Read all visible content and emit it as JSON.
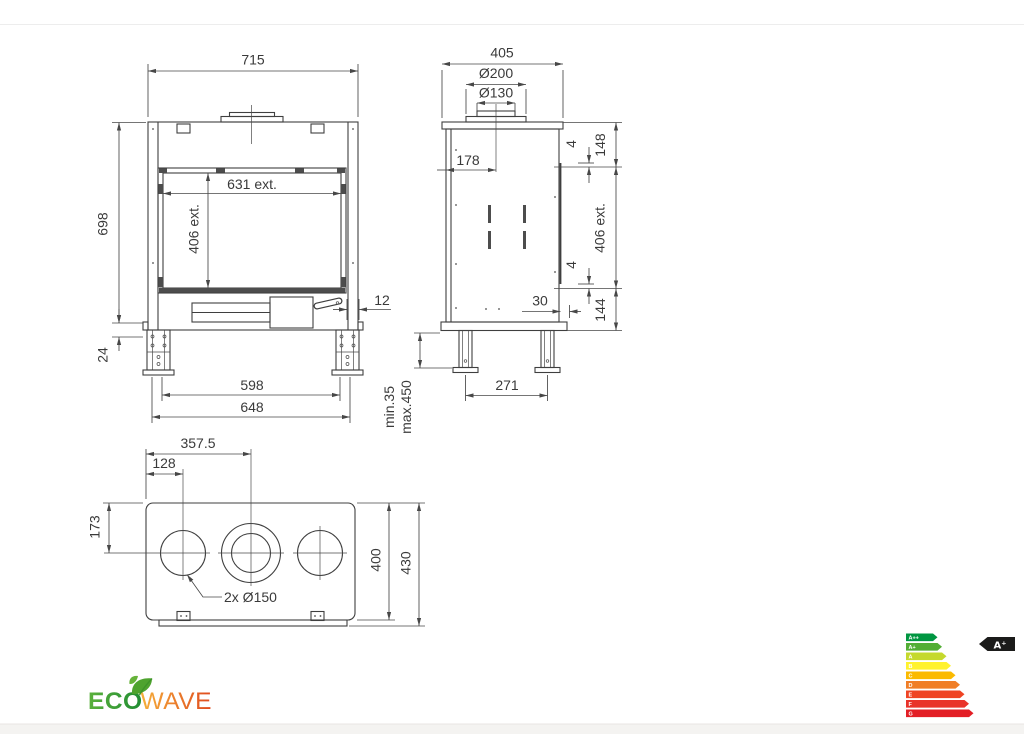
{
  "drawing": {
    "front": {
      "width": "715",
      "height": "698",
      "glass_width": "631 ext.",
      "glass_height": "406 ext.",
      "frame_offset": "12",
      "leg_adjust": "24",
      "feet_inner": "598",
      "feet_outer": "648"
    },
    "side": {
      "depth": "405",
      "flue_outer": "Ø200",
      "flue_inner": "Ø130",
      "flue_center": "178",
      "top_section": "148",
      "gap_top": "4",
      "glass_height": "406 ext.",
      "gap_bottom": "4",
      "bottom_section": "144",
      "glass_offset": "30",
      "leg_min": "min.35",
      "leg_max": "max.450",
      "feet_spacing": "271"
    },
    "bottom": {
      "flue_center_x": "357.5",
      "hole_center_x": "128",
      "hole_center_y": "173",
      "body_depth": "400",
      "total_depth": "430",
      "holes_label": "2x Ø150"
    }
  },
  "logo": {
    "eco": "ECO",
    "wave": "WAVE",
    "eco_color_start": "#5cb13c",
    "eco_color_end": "#1f8c33",
    "wave_color_start": "#f6b03a",
    "wave_color_end": "#df4a1e",
    "leaf_color": "#4ea32e"
  },
  "energy_label": {
    "rating": "A⁺",
    "tag_color": "#1b1b1a",
    "bands": [
      {
        "grade": "A++",
        "color": "#009641"
      },
      {
        "grade": "A+",
        "color": "#52ae34"
      },
      {
        "grade": "A",
        "color": "#c5d92d"
      },
      {
        "grade": "B",
        "color": "#fff22d"
      },
      {
        "grade": "C",
        "color": "#fbba00"
      },
      {
        "grade": "D",
        "color": "#f07e26"
      },
      {
        "grade": "E",
        "color": "#ef4423"
      },
      {
        "grade": "F",
        "color": "#e9332a"
      },
      {
        "grade": "G",
        "color": "#e31e25"
      }
    ]
  }
}
